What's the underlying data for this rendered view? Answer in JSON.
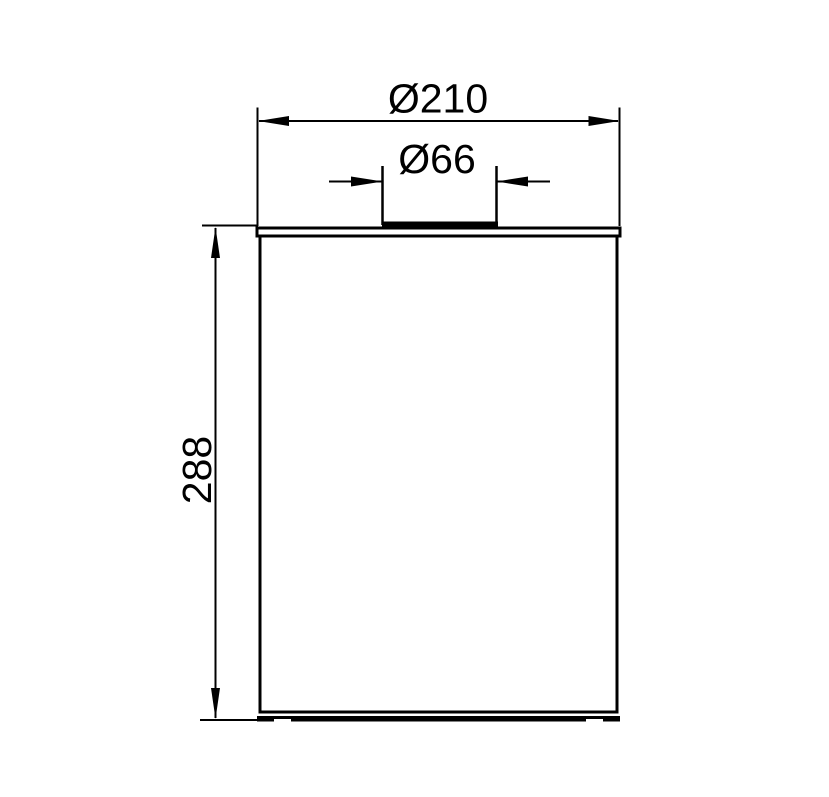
{
  "drawing": {
    "description": "Technical side-elevation dimension drawing of a cylindrical container with a raised lid boss",
    "colors": {
      "line": "#000000",
      "background": "#ffffff"
    },
    "dimensions": {
      "outer_diameter": {
        "label": "Ø210",
        "value": 210,
        "kind": "diameter",
        "orientation": "horizontal"
      },
      "boss_diameter": {
        "label": "Ø66",
        "value": 66,
        "kind": "diameter",
        "orientation": "horizontal"
      },
      "height": {
        "label": "288",
        "value": 288,
        "kind": "linear",
        "orientation": "vertical"
      }
    }
  }
}
